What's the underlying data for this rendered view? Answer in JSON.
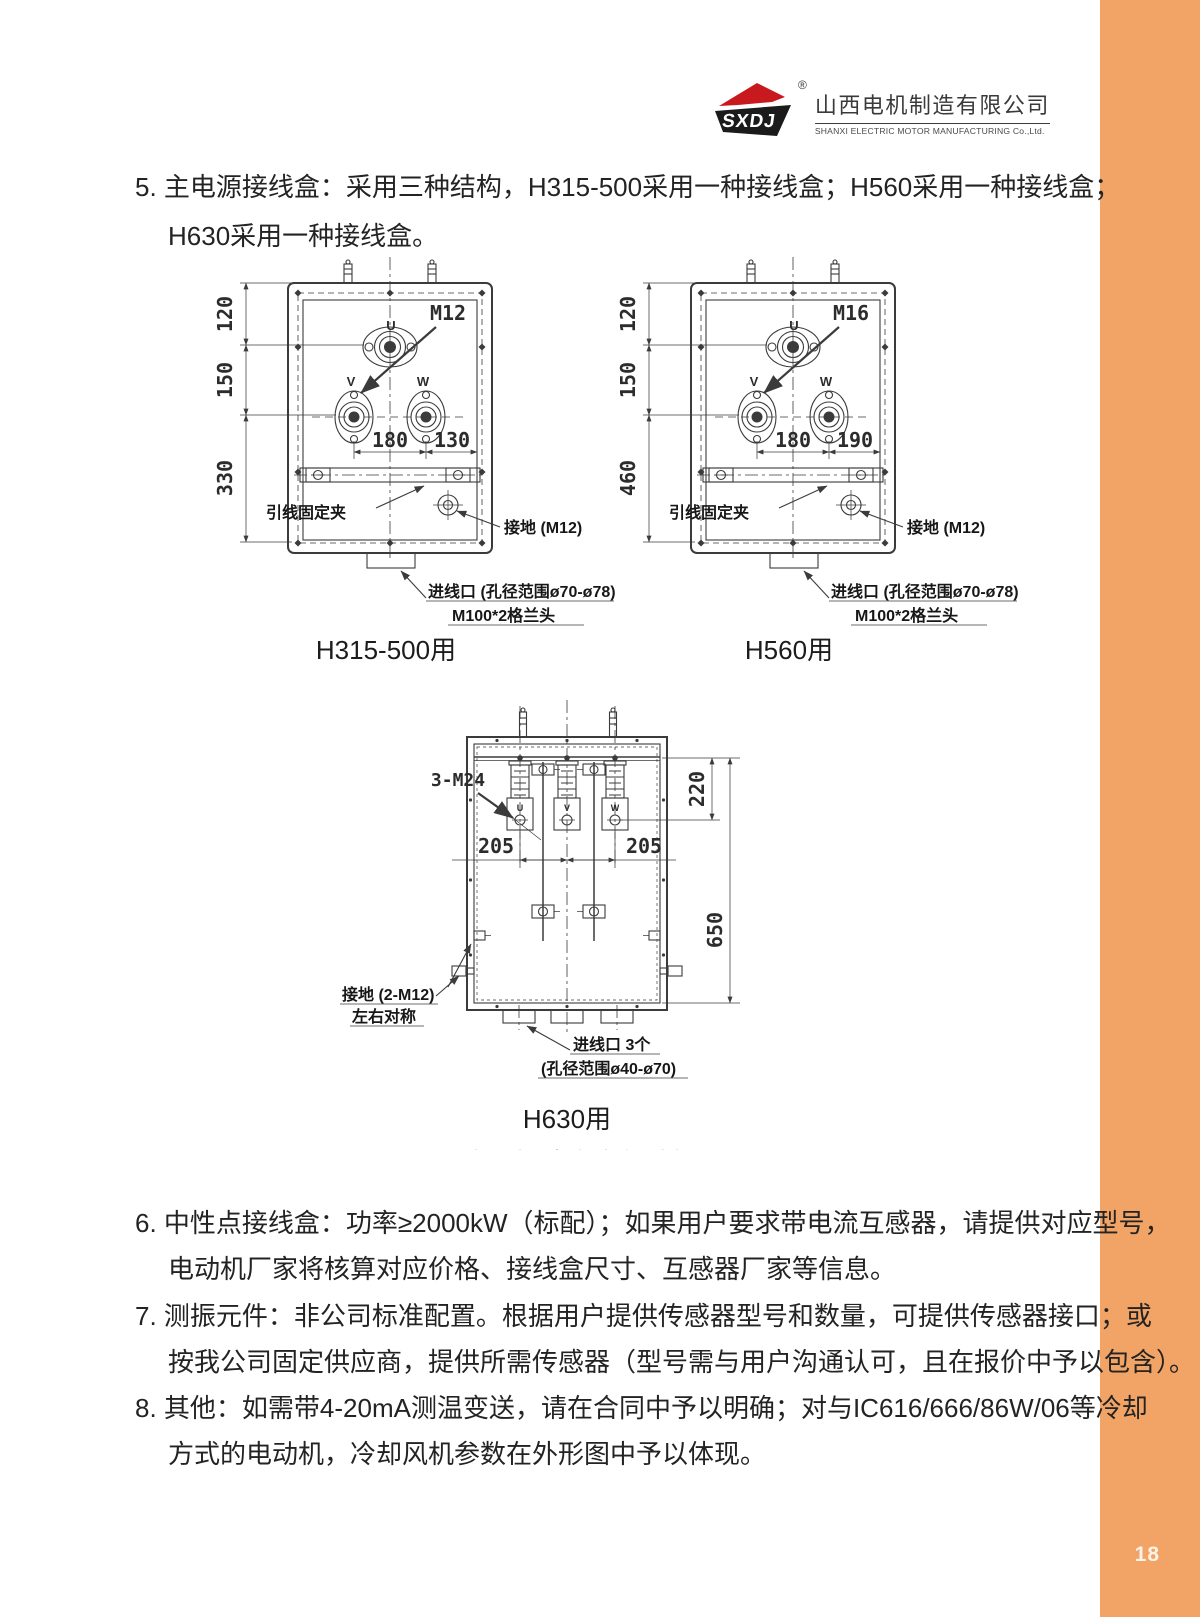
{
  "page": {
    "number": "18"
  },
  "colors": {
    "accent": "#F1A465",
    "line": "#3b3b3b",
    "text": "#232323"
  },
  "logo": {
    "abbr": "SXDJ",
    "reg": "®",
    "company_cn": "山西电机制造有限公司",
    "company_en": "SHANXI ELECTRIC MOTOR MANUFACTURING Co.,Ltd."
  },
  "items": {
    "item5": {
      "line1": "5. 主电源接线盒：采用三种结构，H315-500采用一种接线盒；H560采用一种接线盒；",
      "line2": "H630采用一种接线盒。"
    },
    "item6": {
      "line1": "6. 中性点接线盒：功率≥2000kW（标配）；如果用户要求带电流互感器，请提供对应型号，",
      "line2": "电动机厂家将核算对应价格、接线盒尺寸、互感器厂家等信息。"
    },
    "item7": {
      "line1": "7. 测振元件：非公司标准配置。根据用户提供传感器型号和数量，可提供传感器接口；或",
      "line2": "按我公司固定供应商，提供所需传感器（型号需与用户沟通认可，且在报价中予以包含）。"
    },
    "item8": {
      "line1": "8. 其他：如需带4-20mA测温变送，请在合同中予以明确；对与IC616/666/86W/06等冷却",
      "line2": "方式的电动机，冷却风机参数在外形图中予以体现。"
    }
  },
  "diagram_left": {
    "caption": "H315-500用",
    "dim_v1": "120",
    "dim_v2": "150",
    "dim_v3": "330",
    "dim_h1": "180",
    "dim_h2": "130",
    "terminal_bolt": "M12",
    "u": "U",
    "v": "V",
    "w": "W",
    "clamp": "引线固定夹",
    "ground": "接地 (M12)",
    "entry_line1": "进线口 (孔径范围ø70-ø78)",
    "entry_line2": "M100*2格兰头"
  },
  "diagram_right": {
    "caption": "H560用",
    "dim_v1": "120",
    "dim_v2": "150",
    "dim_v3": "460",
    "dim_h1": "180",
    "dim_h2": "190",
    "terminal_bolt": "M16",
    "u": "U",
    "v": "V",
    "w": "W",
    "clamp": "引线固定夹",
    "ground": "接地 (M12)",
    "entry_line1": "进线口 (孔径范围ø70-ø78)",
    "entry_line2": "M100*2格兰头"
  },
  "diagram_h630": {
    "caption": "H630用",
    "subtitle": "主电源接线盒内部结构",
    "bolt_label": "3-M24",
    "dim_top": "220",
    "dim_left": "205",
    "dim_right": "205",
    "dim_height": "650",
    "u": "U",
    "v": "V",
    "w": "W",
    "ground_line1": "接地 (2-M12)",
    "ground_line2": "左右对称",
    "entry_line1": "进线口 3个",
    "entry_line2": "(孔径范围ø40-ø70)"
  }
}
